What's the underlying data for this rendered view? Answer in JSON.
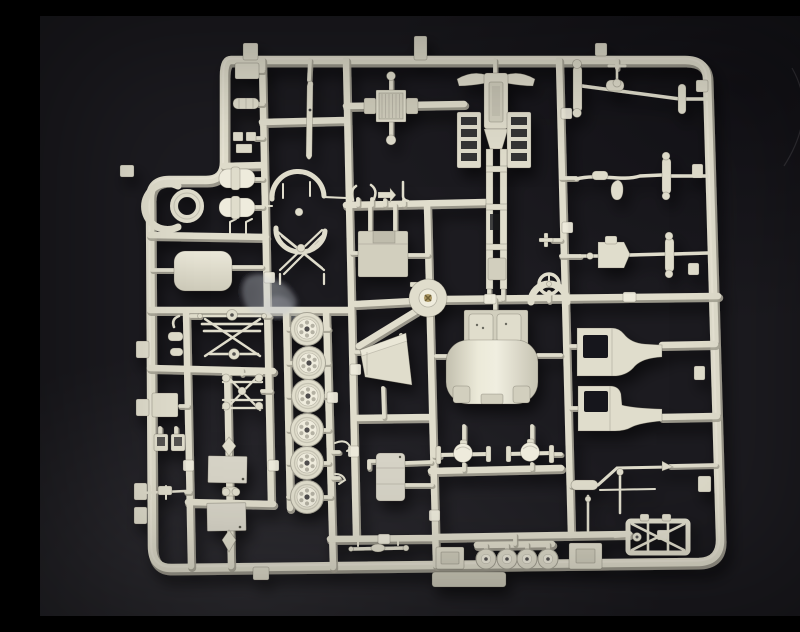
{
  "meta": {
    "title": "Model kit sprue photograph",
    "description": "Overhead photograph of an ivory styrene injection-moulded model-kit sprue (parts tree) for a military truck kit, lying on a dark charcoal background."
  },
  "palette": {
    "bg": "#1c1b20",
    "bg-dark": "#121116",
    "bg-light": "#2f2e33",
    "plastic": "#e0ddcc",
    "plastic-light": "#efecdd",
    "plastic-mid": "#d2cfbe",
    "plastic-dark": "#a6a395",
    "panel": "#d7d4c7",
    "hole": "#19181d",
    "edge": "rgba(62,60,50,0.30)",
    "screw": "#a08a50",
    "blob": "#c3cad0"
  },
  "sprue": {
    "material": "injection-moulded styrene",
    "colour": "ivory / light grey",
    "background": "dark charcoal sweep",
    "parts": [
      {
        "name": "outer-frame-rails",
        "count": 1
      },
      {
        "name": "road-wheel",
        "count": 6
      },
      {
        "name": "small-trailer-wheel",
        "count": 4
      },
      {
        "name": "cab-rear-and-bonnet",
        "count": 1
      },
      {
        "name": "cab-side-panel",
        "count": 2
      },
      {
        "name": "chassis-frame-with-fenders",
        "count": 1
      },
      {
        "name": "radiator-grille",
        "count": 1
      },
      {
        "name": "steering-wheel",
        "count": 1
      },
      {
        "name": "front-axle",
        "count": 3
      },
      {
        "name": "differential-axle",
        "count": 2
      },
      {
        "name": "leaf-spring-set",
        "count": 2
      },
      {
        "name": "fender-arch-set",
        "count": 1
      },
      {
        "name": "fuel-tank",
        "count": 1
      },
      {
        "name": "storage-box-panel",
        "count": 2
      },
      {
        "name": "hood-panel",
        "count": 1
      },
      {
        "name": "engine-box",
        "count": 1
      },
      {
        "name": "air-cleaner-ring",
        "count": 1
      },
      {
        "name": "cylinder-tank",
        "count": 2
      },
      {
        "name": "mud-guard-wedge",
        "count": 1
      },
      {
        "name": "exhaust-pipe",
        "count": 1
      },
      {
        "name": "ladder-sub-frame",
        "count": 1
      },
      {
        "name": "drive-shaft",
        "count": 1
      },
      {
        "name": "moulding-hub-gate",
        "count": 1
      }
    ]
  }
}
